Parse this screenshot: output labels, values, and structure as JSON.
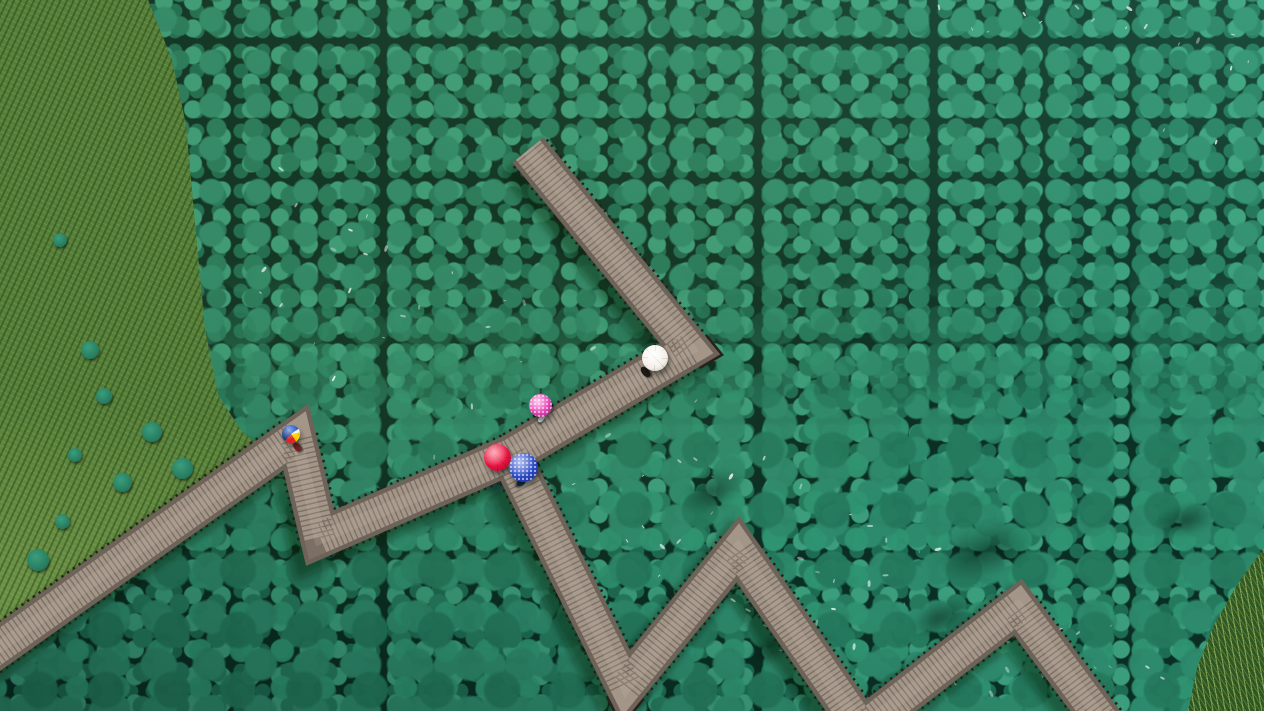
{
  "scene": {
    "description": "Aerial top-down drone view of a grey wooden zigzag boardwalk winding through a dense teal-green lotus pond. Five visitors walk the boardwalk carrying umbrellas: a rainbow-striped umbrella at the left corner, a red and a speckled blue umbrella at the central junction, a bright pink umbrella and a white umbrella on the upper arm. A grassy bank runs along the left edge and a patch of reeds grows in the lower-right corner.",
    "setting": "lotus pond with elevated wooden walkway, photographed from directly above",
    "time_of_day": "daytime"
  },
  "palette": {
    "pond_dark": "#0a2e23",
    "leaf_1": "#2e8a6c",
    "leaf_2": "#257a5e",
    "leaf_3": "#3b9d7b",
    "leaf_4": "#1d6b52",
    "leaf_5": "#2f9472",
    "grass_base": "#45702f",
    "wood_deck": "#a39588",
    "wood_plank": "#564c42",
    "wood_rail": "#6e6358",
    "wood_baluster": "#26211c",
    "wood_sheen": "#cfc3b2",
    "shadow": "rgba(4,18,12,0.40)",
    "umb_red": "#e4123f",
    "umb_blue": "#2746c4",
    "umb_pink": "#e042b0",
    "umb_white": "#f3eee7"
  },
  "boardwalk": {
    "material": "wooden planks with post railings",
    "deck_width_px": 31,
    "rail_width_px": 45,
    "polylines": [
      [
        [
          -12,
          655
        ],
        [
          296,
          437
        ],
        [
          320,
          538
        ],
        [
          510,
          455
        ],
        [
          690,
          349
        ],
        [
          528,
          150
        ]
      ],
      [
        [
          510,
          455
        ],
        [
          626,
          687
        ],
        [
          738,
          549
        ],
        [
          862,
          728
        ],
        [
          1018,
          607
        ],
        [
          1108,
          728
        ]
      ]
    ]
  },
  "umbrellas": [
    {
      "name": "rainbow-umbrella",
      "color_label": "blue-yellow-red striped",
      "style": "rainbow",
      "x": 291,
      "y": 434,
      "size": 18
    },
    {
      "name": "red-umbrella",
      "color_label": "red",
      "style": "red",
      "x": 497,
      "y": 457,
      "size": 27
    },
    {
      "name": "blue-umbrella",
      "color_label": "speckled blue",
      "style": "blue",
      "x": 523,
      "y": 467,
      "size": 29
    },
    {
      "name": "pink-umbrella",
      "color_label": "speckled pink",
      "style": "pink",
      "x": 540,
      "y": 405,
      "size": 23
    },
    {
      "name": "white-umbrella",
      "color_label": "white",
      "style": "white",
      "x": 655,
      "y": 358,
      "size": 26
    }
  ],
  "people": [
    {
      "name": "person-under-white-umbrella",
      "x": 645,
      "y": 372,
      "angle": -40,
      "color": "#1d1a18",
      "w": 7,
      "h": 12
    },
    {
      "name": "person-under-rainbow-umbrella",
      "x": 297,
      "y": 447,
      "angle": -35,
      "color": "#7a1f1f",
      "w": 6,
      "h": 10
    },
    {
      "name": "person-under-pink-umbrella",
      "x": 541,
      "y": 418,
      "angle": 40,
      "color": "#cfd4d8",
      "w": 5,
      "h": 9
    },
    {
      "name": "person-under-blue-umbrella",
      "x": 521,
      "y": 482,
      "angle": 65,
      "color": "#14254f",
      "w": 6,
      "h": 9
    }
  ],
  "water_patches": [
    {
      "x": 985,
      "y": 550,
      "w": 105,
      "h": 55,
      "rot": -18
    },
    {
      "x": 712,
      "y": 492,
      "w": 70,
      "h": 38,
      "rot": -25
    },
    {
      "x": 622,
      "y": 664,
      "w": 82,
      "h": 42,
      "rot": -15
    },
    {
      "x": 772,
      "y": 648,
      "w": 56,
      "h": 30,
      "rot": -30
    },
    {
      "x": 940,
      "y": 618,
      "w": 64,
      "h": 34,
      "rot": -22
    },
    {
      "x": 1185,
      "y": 520,
      "w": 66,
      "h": 34,
      "rot": -14
    },
    {
      "x": 548,
      "y": 522,
      "w": 42,
      "h": 24,
      "rot": -20
    }
  ],
  "vegetation": {
    "grass_bank": "left edge, tapering from top-left corner down to the boardwalk",
    "reeds": "lower-right corner",
    "lotus_overlap_dots": [
      [
        75,
        455
      ],
      [
        122,
        482
      ],
      [
        62,
        521
      ],
      [
        152,
        432
      ],
      [
        104,
        396
      ],
      [
        182,
        468
      ],
      [
        142,
        540
      ],
      [
        38,
        560
      ],
      [
        90,
        350
      ],
      [
        60,
        240
      ]
    ]
  }
}
